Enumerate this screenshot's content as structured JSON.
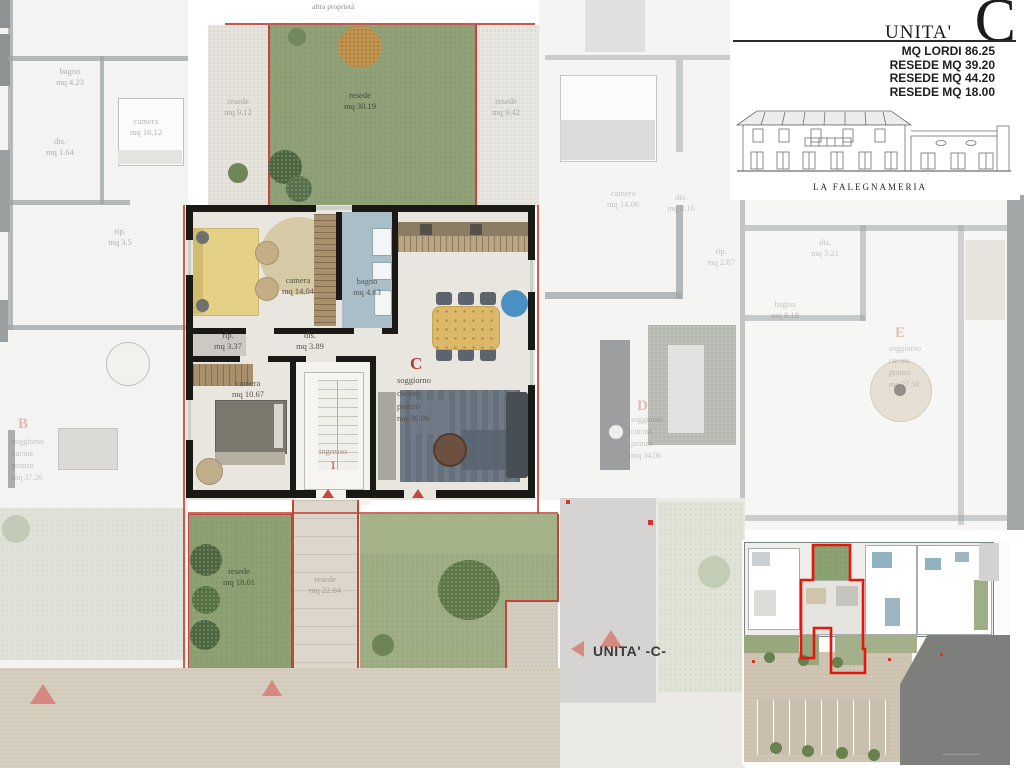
{
  "top_note": "altra proprietà",
  "title_block": {
    "unit_word": "UNITA'",
    "unit_letter": "C",
    "stats": [
      "MQ LORDI 86.25",
      "RESEDE MQ 39.20",
      "RESEDE MQ 44.20",
      "RESEDE MQ 18.00"
    ],
    "building_name": "LA FALEGNAMERIA"
  },
  "unit_c": {
    "letter": "C",
    "camera1": {
      "name": "camera",
      "area": "mq 14.04"
    },
    "bagno": {
      "name": "bagno",
      "area": "mq 4.63"
    },
    "rip": {
      "name": "rip.",
      "area": "mq 3.37"
    },
    "dis": {
      "name": "dis.",
      "area": "mq 3.89"
    },
    "camera2": {
      "name": "camera",
      "area": "mq 10.67"
    },
    "ingresso": {
      "name": "ingresso",
      "level": "1"
    },
    "soggiorno": {
      "line1": "soggiorno",
      "line2": "cucina",
      "line3": "pranzo",
      "area": "mq 36.06"
    }
  },
  "resede": {
    "top": {
      "name": "resede",
      "area": "mq 30.19"
    },
    "top_left": {
      "name": "resede",
      "area": "mq 9.12"
    },
    "top_right": {
      "name": "resede",
      "area": "mq 9.42"
    },
    "bottom_left": {
      "name": "resede",
      "area": "mq 18.01"
    },
    "bottom_path": {
      "name": "resede",
      "area": "mq 22.64"
    }
  },
  "neighbors": {
    "a_bagno": {
      "name": "bagno",
      "area": "mq 4.23"
    },
    "a_camera": {
      "name": "camera",
      "area": "mq 16.12"
    },
    "a_dis": {
      "name": "dis.",
      "area": "mq 1.64"
    },
    "a_rip": {
      "name": "rip.",
      "area": "mq 3.5"
    },
    "unit_b": {
      "letter": "B",
      "line1": "soggiorno",
      "line2": "cucina",
      "line3": "pranzo",
      "area": "mq 37.26"
    },
    "d_camera": {
      "name": "camera",
      "area": "mq 14.06"
    },
    "d_dis": {
      "name": "dis.",
      "area": "mq 3.16"
    },
    "d_rip": {
      "name": "rip.",
      "area": "mq 2.87"
    },
    "unit_d": {
      "letter": "D",
      "line1": "soggiorno",
      "line2": "cucina",
      "line3": "pranzo",
      "area": "mq 34.06"
    },
    "e_dis": {
      "name": "dis.",
      "area": "mq 3.21"
    },
    "e_bagno": {
      "name": "bagno",
      "area": "mq 8.18"
    },
    "unit_e": {
      "letter": "E",
      "line1": "soggiorno",
      "line2": "cucina",
      "line3": "pranzo",
      "area": "mq 27.50"
    }
  },
  "footer": {
    "unit_ref": "UNITA' -C-"
  },
  "colors": {
    "accent_red": "#b5392e",
    "boundary_red": "#c0453a",
    "wall_black": "#1b1916",
    "garden_green": "#90a178",
    "bagno_blue": "#a9bec6",
    "bed_yellow": "#e4d186",
    "table_gold": "#dcb96a",
    "blue_rug": "#4a90c2",
    "plaza": "#d6cfc0",
    "road_grey": "#7e7e7c"
  }
}
